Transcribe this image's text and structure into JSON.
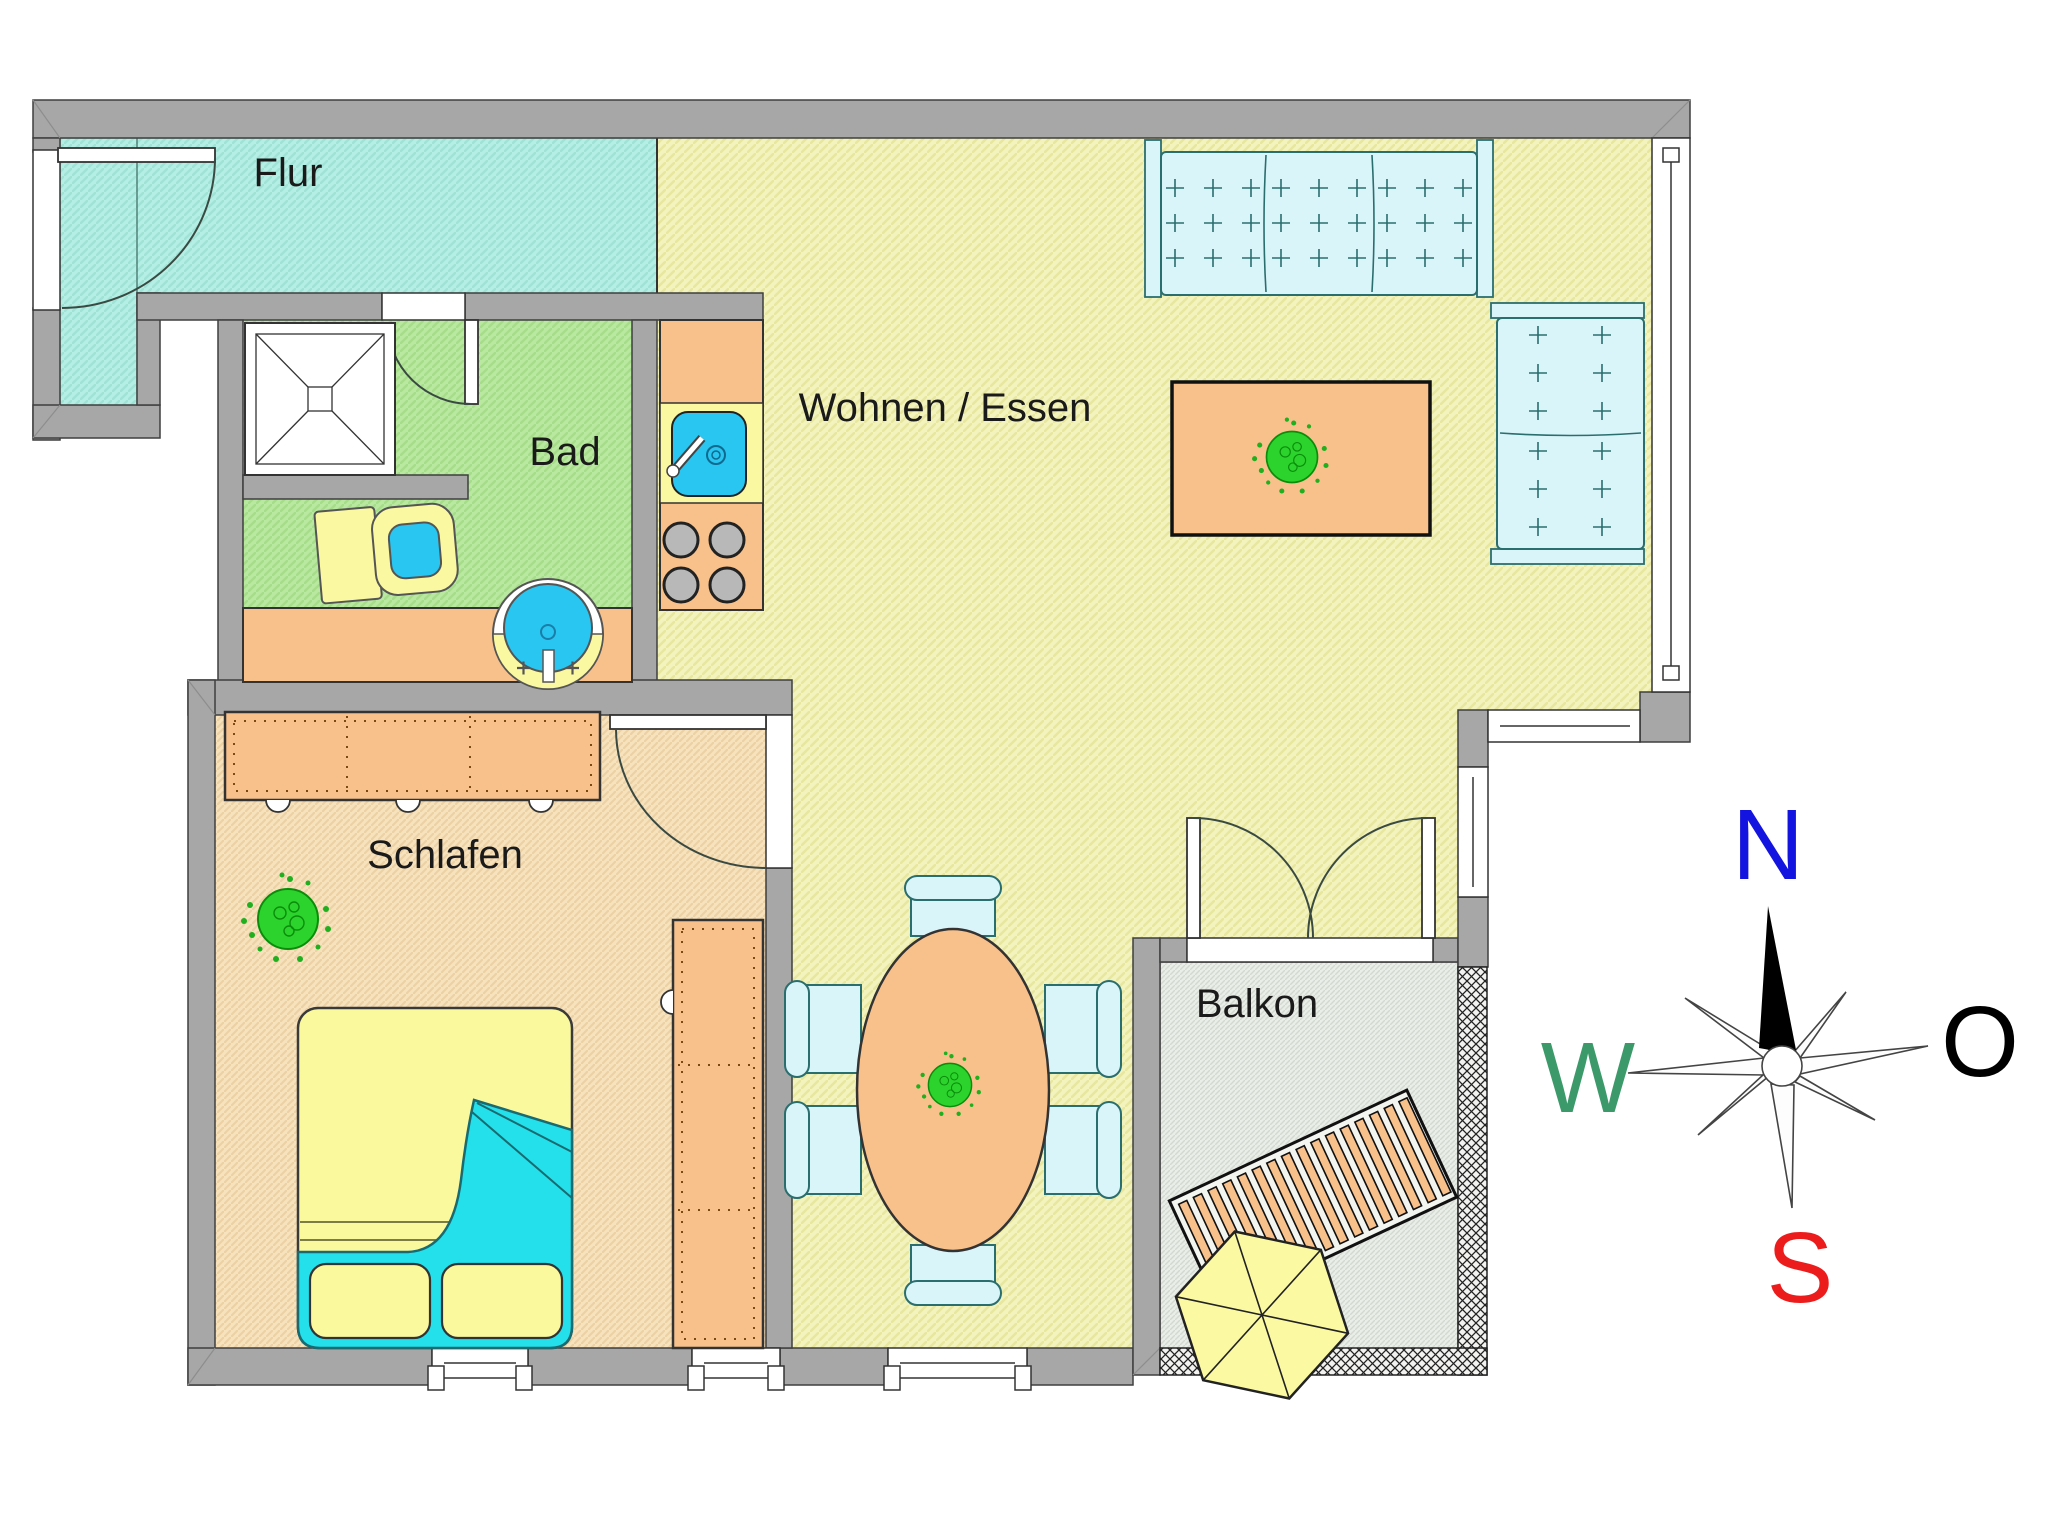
{
  "document": {
    "type": "floor-plan",
    "language": "de"
  },
  "rooms": {
    "flur": {
      "label": "Flur"
    },
    "bad": {
      "label": "Bad"
    },
    "wohnen": {
      "label": "Wohnen / Essen"
    },
    "schlafen": {
      "label": "Schlafen"
    },
    "balkon": {
      "label": "Balkon"
    }
  },
  "compass": {
    "north": "N",
    "east": "O",
    "south": "S",
    "west": "W",
    "north_color": "#1414e0",
    "east_color": "#000000",
    "south_color": "#ec1c1c",
    "west_color": "#3c9a6a"
  },
  "colors": {
    "wall": "#a7a7a7",
    "floor_flur": "#b4eee4",
    "floor_bad": "#b9e8a0",
    "floor_wohnen": "#f3f3be",
    "floor_schlafen": "#f7e2be",
    "floor_balkon": "#eaeee8",
    "furniture_orange": "#f8c18b",
    "fixture_yellow": "#faf8a0",
    "fixture_blue": "#28c6f0",
    "blanket_cyan": "#23e0eb",
    "upholstery_blue": "#daf5fa",
    "plant_green": "#2cd32c"
  }
}
